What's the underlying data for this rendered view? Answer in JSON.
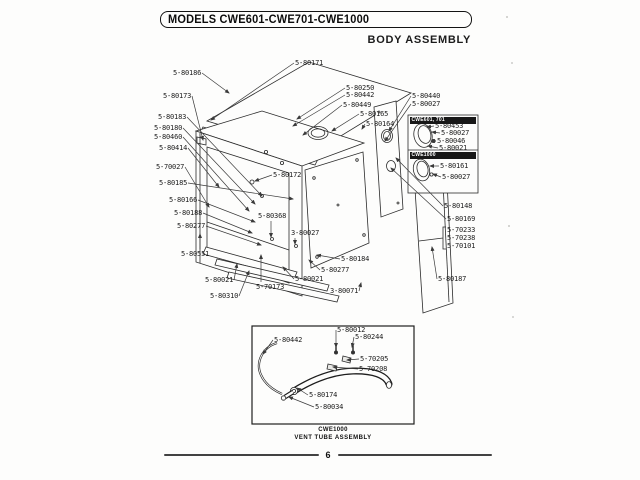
{
  "header": {
    "models": "MODELS CWE601-CWE701-CWE1000",
    "subtitle": "BODY ASSEMBLY"
  },
  "footer": {
    "page_number": "6"
  },
  "diagram": {
    "labels": [
      {
        "text": "5-80186",
        "x": 173,
        "y": 69,
        "ax": 229,
        "ay": 93
      },
      {
        "text": "5-80173",
        "x": 163,
        "y": 92,
        "ax": 203,
        "ay": 140
      },
      {
        "text": "5-80183",
        "x": 158,
        "y": 113,
        "ax": 262,
        "ay": 196
      },
      {
        "text": "5-80180",
        "x": 154,
        "y": 124,
        "ax": 255,
        "ay": 204
      },
      {
        "text": "5-80460",
        "x": 154,
        "y": 133,
        "ax": 249,
        "ay": 211
      },
      {
        "text": "5-80414",
        "x": 159,
        "y": 144,
        "ax": 219,
        "ay": 187
      },
      {
        "text": "5-70027",
        "x": 156,
        "y": 163,
        "ax": 209,
        "ay": 207
      },
      {
        "text": "5-80185",
        "x": 159,
        "y": 179,
        "ax": 293,
        "ay": 199
      },
      {
        "text": "5-80166",
        "x": 169,
        "y": 196,
        "ax": 255,
        "ay": 222
      },
      {
        "text": "5-80188",
        "x": 174,
        "y": 209,
        "ax": 252,
        "ay": 233
      },
      {
        "text": "5-80277",
        "x": 177,
        "y": 222,
        "ax": 261,
        "ay": 245
      },
      {
        "text": "5-80551",
        "x": 181,
        "y": 250,
        "ax": 200,
        "ay": 234
      },
      {
        "text": "5-80021",
        "x": 205,
        "y": 276,
        "ax": 237,
        "ay": 264
      },
      {
        "text": "5-80310",
        "x": 210,
        "y": 292,
        "ax": 249,
        "ay": 271
      },
      {
        "text": "5-70173",
        "x": 256,
        "y": 283,
        "ax": 261,
        "ay": 255
      },
      {
        "text": "5-80021",
        "x": 295,
        "y": 275,
        "ax": 283,
        "ay": 267
      },
      {
        "text": "5-80277",
        "x": 321,
        "y": 266,
        "ax": 309,
        "ay": 260
      },
      {
        "text": "5-80184",
        "x": 341,
        "y": 255,
        "ax": 317,
        "ay": 255
      },
      {
        "text": "3-80071",
        "x": 330,
        "y": 287,
        "ax": 361,
        "ay": 283
      },
      {
        "text": "3-80027",
        "x": 291,
        "y": 229,
        "ax": 295,
        "ay": 244
      },
      {
        "text": "5-80368",
        "x": 258,
        "y": 212,
        "ax": 271,
        "ay": 237
      },
      {
        "text": "5-80172",
        "x": 273,
        "y": 171,
        "ax": 255,
        "ay": 181
      },
      {
        "text": "5-80171",
        "x": 295,
        "y": 59,
        "ax": 211,
        "ay": 120
      },
      {
        "text": "5-80250",
        "x": 346,
        "y": 84,
        "ax": 297,
        "ay": 119
      },
      {
        "text": "5-80442",
        "x": 346,
        "y": 91,
        "ax": 293,
        "ay": 126
      },
      {
        "text": "5-80449",
        "x": 343,
        "y": 101,
        "ax": 303,
        "ay": 135
      },
      {
        "text": "5-80165",
        "x": 360,
        "y": 110,
        "ax": 332,
        "ay": 131
      },
      {
        "text": "5-80164",
        "x": 366,
        "y": 120,
        "ax": 362,
        "ay": 129
      },
      {
        "text": "5-80440",
        "x": 412,
        "y": 92,
        "ax": 389,
        "ay": 131
      },
      {
        "text": "5-80027",
        "x": 412,
        "y": 100,
        "ax": 385,
        "ay": 141
      },
      {
        "text": "5-80148",
        "x": 444,
        "y": 202,
        "ax": 396,
        "ay": 158
      },
      {
        "text": "5-80169",
        "x": 447,
        "y": 215,
        "ax": 391,
        "ay": 168
      },
      {
        "text": "5-70233",
        "x": 447,
        "y": 226
      },
      {
        "text": "5-70238",
        "x": 447,
        "y": 234
      },
      {
        "text": "5-70101",
        "x": 447,
        "y": 242
      },
      {
        "text": "5-80187",
        "x": 438,
        "y": 275,
        "ax": 432,
        "ay": 247
      }
    ]
  },
  "inset": {
    "sections": [
      {
        "title": "CWE601, 701",
        "labels": [
          {
            "text": "5-80453",
            "x": 435,
            "y": 122,
            "ax": 427,
            "ay": 127
          },
          {
            "text": "5-80027",
            "x": 441,
            "y": 129,
            "ax": 432,
            "ay": 132
          },
          {
            "text": "5-80046",
            "x": 437,
            "y": 137,
            "ax": 431,
            "ay": 141
          },
          {
            "text": "5-80021",
            "x": 439,
            "y": 144,
            "ax": 428,
            "ay": 146
          }
        ]
      },
      {
        "title": "CWE1000",
        "labels": [
          {
            "text": "5-80161",
            "x": 440,
            "y": 162,
            "ax": 430,
            "ay": 166
          },
          {
            "text": "5-80027",
            "x": 442,
            "y": 173,
            "ax": 433,
            "ay": 174
          }
        ]
      }
    ]
  },
  "vent": {
    "caption_line1": "CWE1000",
    "caption_line2": "VENT TUBE ASSEMBLY",
    "labels": [
      {
        "text": "5-80442",
        "x": 274,
        "y": 336,
        "ax": 263,
        "ay": 354
      },
      {
        "text": "5-80012",
        "x": 337,
        "y": 326,
        "ax": 336,
        "ay": 347
      },
      {
        "text": "5-80244",
        "x": 355,
        "y": 333,
        "ax": 352,
        "ay": 347
      },
      {
        "text": "5-70205",
        "x": 360,
        "y": 355,
        "ax": 347,
        "ay": 360
      },
      {
        "text": "5-70208",
        "x": 359,
        "y": 365,
        "ax": 333,
        "ay": 367
      },
      {
        "text": "5-80174",
        "x": 309,
        "y": 391,
        "ax": 297,
        "ay": 388
      },
      {
        "text": "5-80034",
        "x": 315,
        "y": 403,
        "ax": 289,
        "ay": 397
      }
    ]
  }
}
